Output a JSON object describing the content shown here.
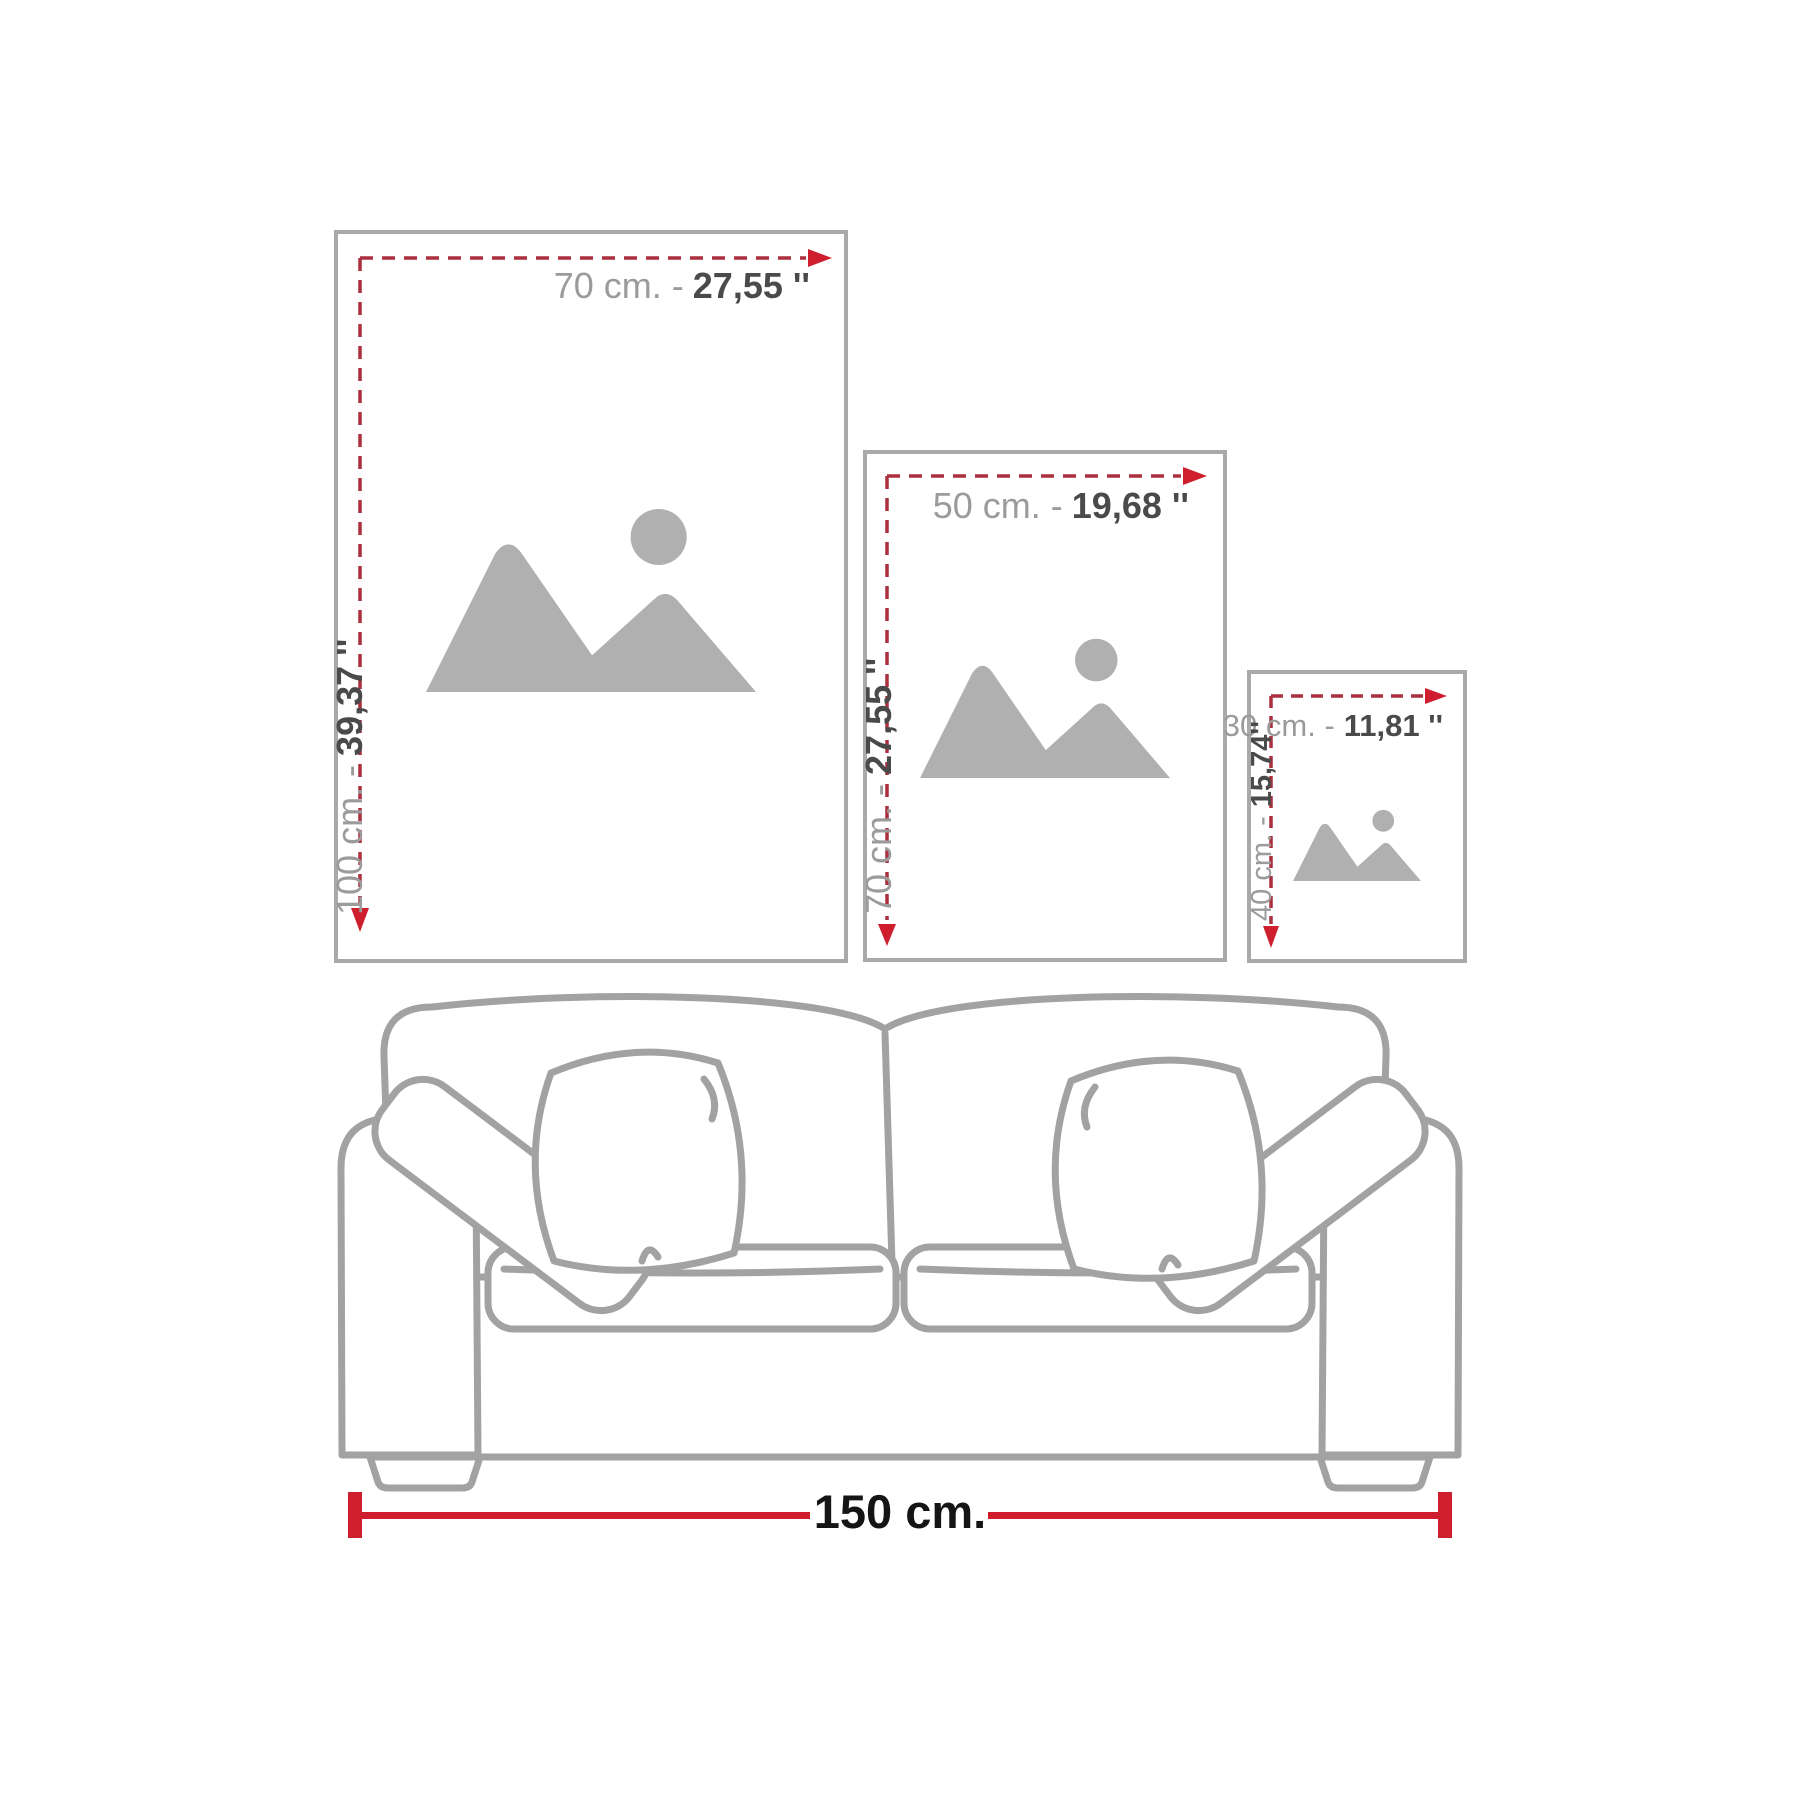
{
  "diagram": {
    "type": "wall-art-size-guide",
    "frames": [
      {
        "name": "large",
        "width_cm": "70 cm. -",
        "width_in": "27,55 ''",
        "height_cm": "100 cm. -",
        "height_in": "39,37 ''"
      },
      {
        "name": "medium",
        "width_cm": "50 cm. -",
        "width_in": "19,68 ''",
        "height_cm": "70 cm. -",
        "height_in": "27,55 ''"
      },
      {
        "name": "small",
        "width_cm": "30 cm. -",
        "width_in": "11,81 ''",
        "height_cm": "40 cm. -",
        "height_in": "15,74''"
      }
    ],
    "sofa": {
      "width_label": "150 cm."
    },
    "icons": {
      "image_placeholder": "mountains-and-sun-image-placeholder",
      "dimension_arrow": "red-arrowhead"
    },
    "colors": {
      "frame_border": "#a9a9a9",
      "dash_red": "#ac2f3e",
      "arrow_red": "#cf1f2e",
      "measure_red": "#cf1f2e",
      "label_cm_gray": "#9b9b9b",
      "label_in_dark": "#4a4a4a",
      "sofa_line_gray": "#a2a2a2",
      "placeholder_gray": "#b0b0b0",
      "measure_text": "#151515"
    }
  }
}
